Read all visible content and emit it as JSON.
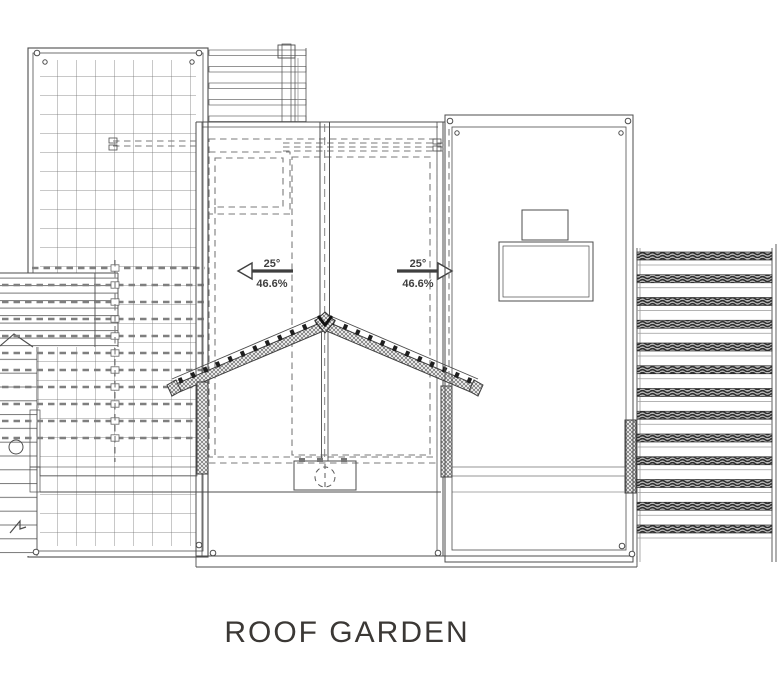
{
  "drawing": {
    "title": "ROOF GARDEN",
    "slopes": {
      "left": {
        "angle": "25°",
        "grade": "46.6%",
        "direction": "left"
      },
      "right": {
        "angle": "25°",
        "grade": "46.6%",
        "direction": "right"
      }
    },
    "colors": {
      "line": "#4d4d4d",
      "line_light": "#8b8b8b",
      "text": "#3b3835",
      "louver_fill": "#e9e9e9",
      "paper": "#ffffff"
    }
  }
}
